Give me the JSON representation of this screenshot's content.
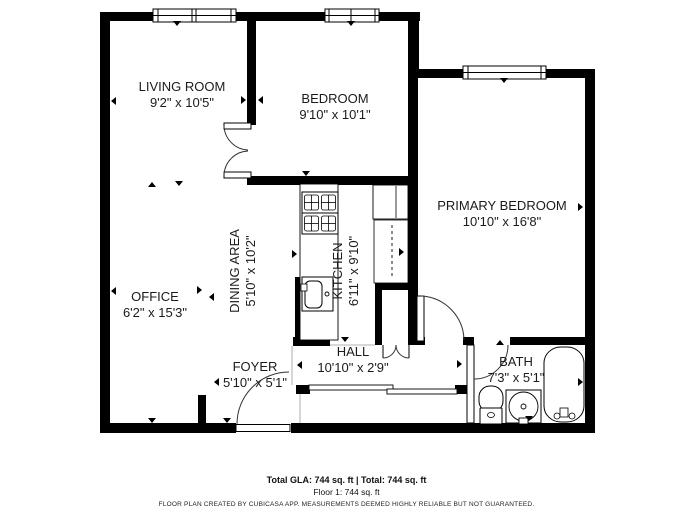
{
  "title": "Floor plan",
  "rooms": [
    {
      "name": "LIVING ROOM",
      "dims": "9'2\" x 10'5\""
    },
    {
      "name": "BEDROOM",
      "dims": "9'10\" x 10'1\""
    },
    {
      "name": "PRIMARY BEDROOM",
      "dims": "10'10\" x 16'8\""
    },
    {
      "name": "DINING AREA",
      "dims": "5'10\" x 10'2\""
    },
    {
      "name": "KITCHEN",
      "dims": "6'11\" x 9'10\""
    },
    {
      "name": "OFFICE",
      "dims": "6'2\" x 15'3\""
    },
    {
      "name": "FOYER",
      "dims": "5'10\" x 5'1\""
    },
    {
      "name": "HALL",
      "dims": "10'10\" x 2'9\""
    },
    {
      "name": "BATH",
      "dims": "7'3\" x 5'1\""
    }
  ],
  "footer": {
    "total_line": "Total GLA: 744 sq. ft | Total: 744 sq. ft",
    "floor_line": "Floor 1: 744 sq. ft",
    "disclaimer": "FLOOR PLAN CREATED BY CUBICASA APP. MEASUREMENTS DEEMED HIGHLY RELIABLE BUT NOT GUARANTEED."
  },
  "colors": {
    "wall": "#000000",
    "background": "#ffffff",
    "text": "#1b1b1b"
  }
}
